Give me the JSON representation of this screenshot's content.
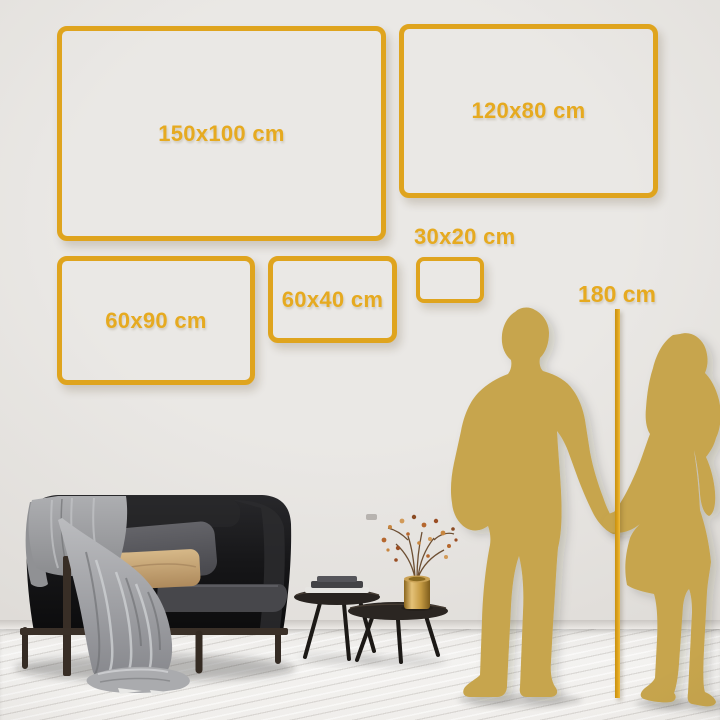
{
  "frames": [
    {
      "id": "150x100",
      "label": "150x100 cm"
    },
    {
      "id": "120x80",
      "label": "120x80 cm"
    },
    {
      "id": "60x90",
      "label": "60x90 cm"
    },
    {
      "id": "60x40",
      "label": "60x40 cm"
    },
    {
      "id": "30x20",
      "label": "30x20 cm"
    }
  ],
  "height_marker": {
    "label": "180 cm"
  },
  "colors": {
    "gold": "#DFA41E",
    "gold_text": "#E6AA20",
    "silhouette": "#C7A54E"
  }
}
